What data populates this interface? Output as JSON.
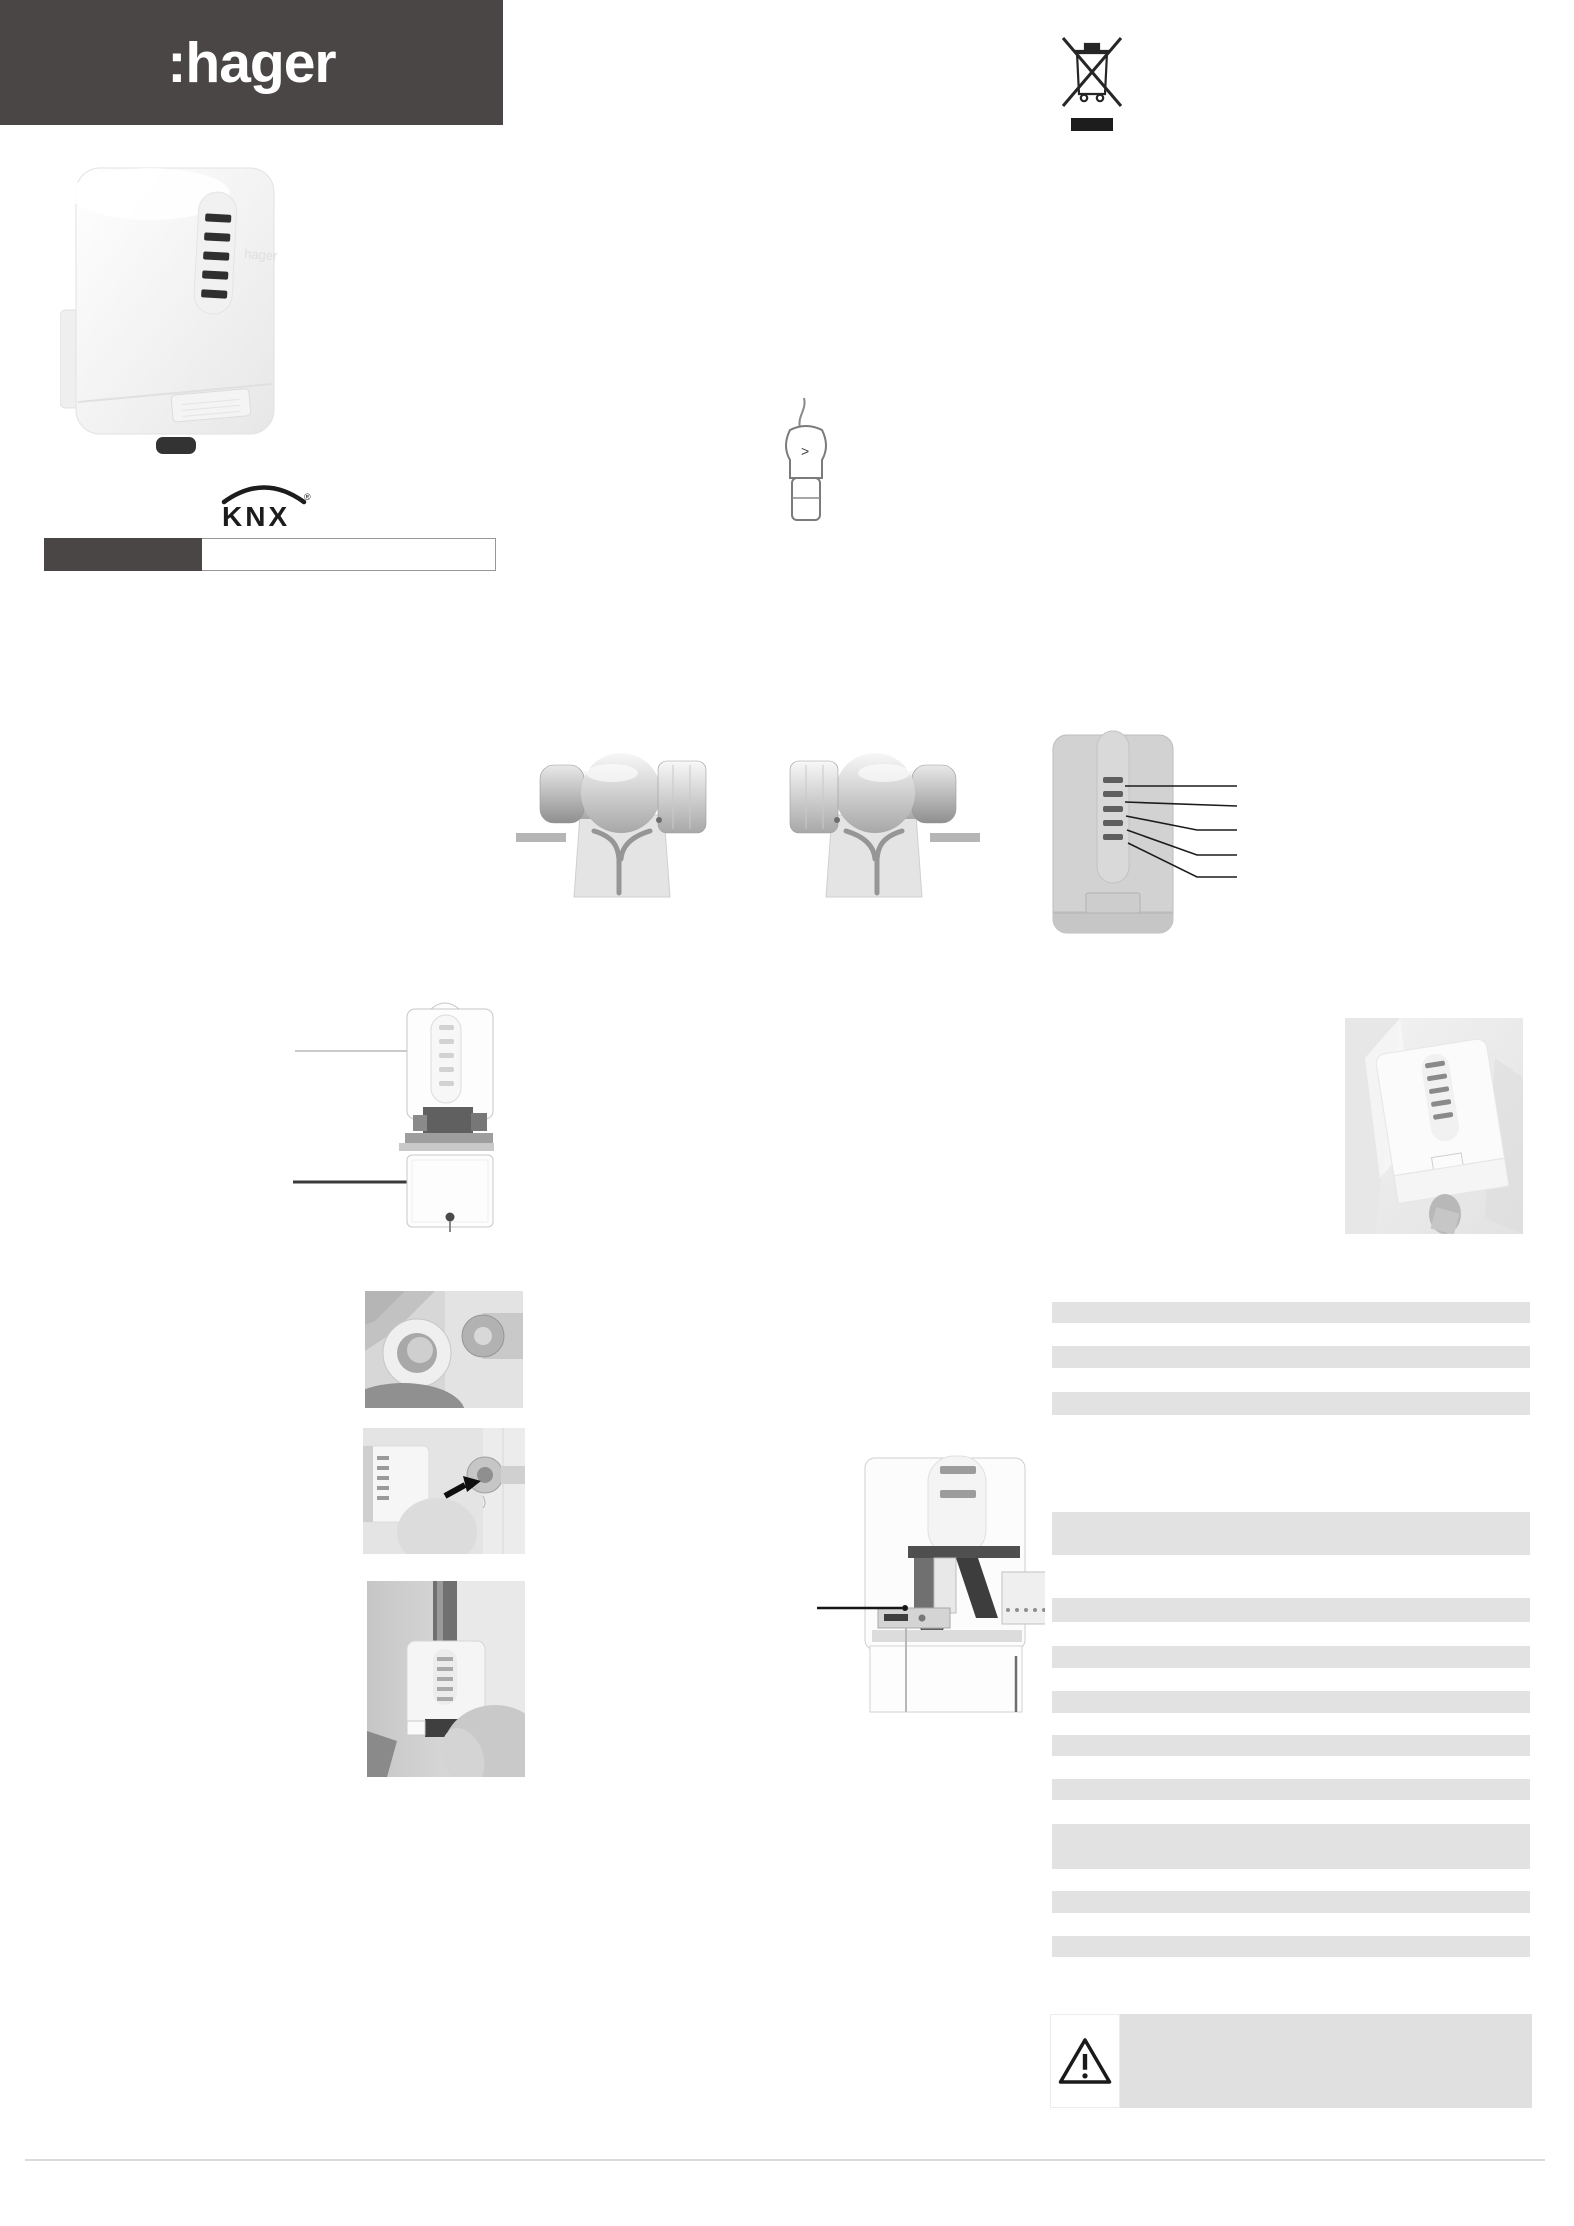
{
  "header": {
    "brand_logo_text": ":hager",
    "bar_color": "#4a4646"
  },
  "branding": {
    "knx_text": "KNX",
    "knx_mark": "®"
  },
  "product": {
    "face_print": "hager",
    "led_slot_count": 5
  },
  "regulatory": {
    "weee_icon": "crossed-out-wheeled-bin-with-bar"
  },
  "handheld": {
    "icon": "handheld-programmer",
    "screen_glyph": ">"
  },
  "diagrams": {
    "valve_illustration_count": 2,
    "front_view": {
      "led_callout_count": 5
    },
    "exploded_view": {
      "callout_count": 2
    },
    "cutaway_view": {
      "callout_count": 1,
      "vertical_callout_count": 2
    }
  },
  "two_tone_bar": {
    "filled_color": "#4a4646",
    "filled_width_px": 158,
    "total_width_px": 452
  },
  "right_column": {
    "bar_color": "#e2e2e2",
    "left_px": 1052,
    "width_px": 478,
    "bars": [
      {
        "top": 1302,
        "height": 21
      },
      {
        "top": 1346,
        "height": 22
      },
      {
        "top": 1392,
        "height": 23
      },
      {
        "top": 1512,
        "height": 43
      },
      {
        "top": 1598,
        "height": 24
      },
      {
        "top": 1646,
        "height": 22
      },
      {
        "top": 1691,
        "height": 22
      },
      {
        "top": 1735,
        "height": 21
      },
      {
        "top": 1779,
        "height": 21
      },
      {
        "top": 1824,
        "height": 45
      },
      {
        "top": 1891,
        "height": 22
      },
      {
        "top": 1936,
        "height": 21
      }
    ]
  },
  "warning": {
    "icon": "exclamation-triangle"
  }
}
